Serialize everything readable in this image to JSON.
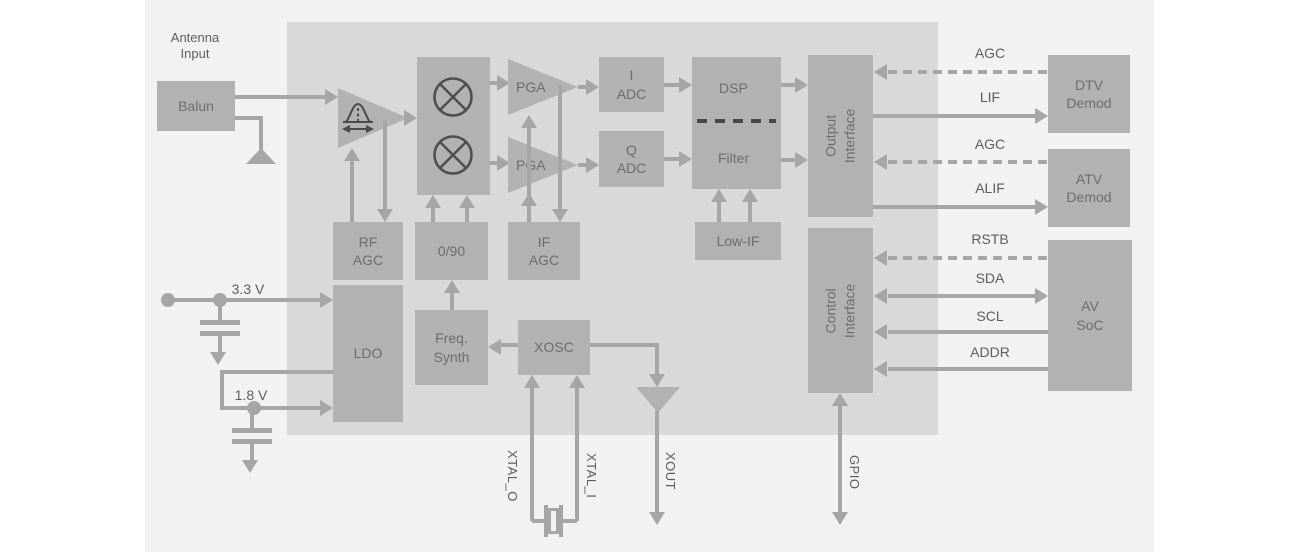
{
  "colors": {
    "page_bg": "#ffffff",
    "panel_bg": "#f2f2f2",
    "chip_bg": "#d9d9d9",
    "block_fill": "#b2b2b2",
    "line": "#a6a6a6",
    "block_text": "#6d6d6d",
    "label_text": "#5d5d5d",
    "dsp_filter_divider": "#474747",
    "symbol_glyph": "#4a4a4a"
  },
  "labels": {
    "antenna_input": "Antenna\nInput",
    "v33": "3.3 V",
    "v18": "1.8 V"
  },
  "blocks": {
    "balun": "Balun",
    "pga_top": "PGA",
    "pga_bottom": "PGA",
    "i_adc": "I\nADC",
    "q_adc": "Q\nADC",
    "dsp": "DSP",
    "filter": "Filter",
    "output_interface": "Output\nInterface",
    "control_interface": "Control\nInterface",
    "rf_agc": "RF\nAGC",
    "phase_0_90": "0/90",
    "if_agc": "IF\nAGC",
    "low_if": "Low-IF",
    "ldo": "LDO",
    "freq_synth": "Freq.\nSynth",
    "xosc": "XOSC",
    "dtv_demod": "DTV\nDemod",
    "atv_demod": "ATV\nDemod",
    "av_soc": "AV\nSoC"
  },
  "signals": {
    "agc_dtv": "AGC",
    "lif": "LIF",
    "agc_atv": "AGC",
    "alif": "ALIF",
    "rstb": "RSTB",
    "sda": "SDA",
    "scl": "SCL",
    "addr": "ADDR",
    "gpio": "GPIO",
    "xout": "XOUT",
    "xtal_o": "XTAL_O",
    "xtal_i": "XTAL_I"
  }
}
